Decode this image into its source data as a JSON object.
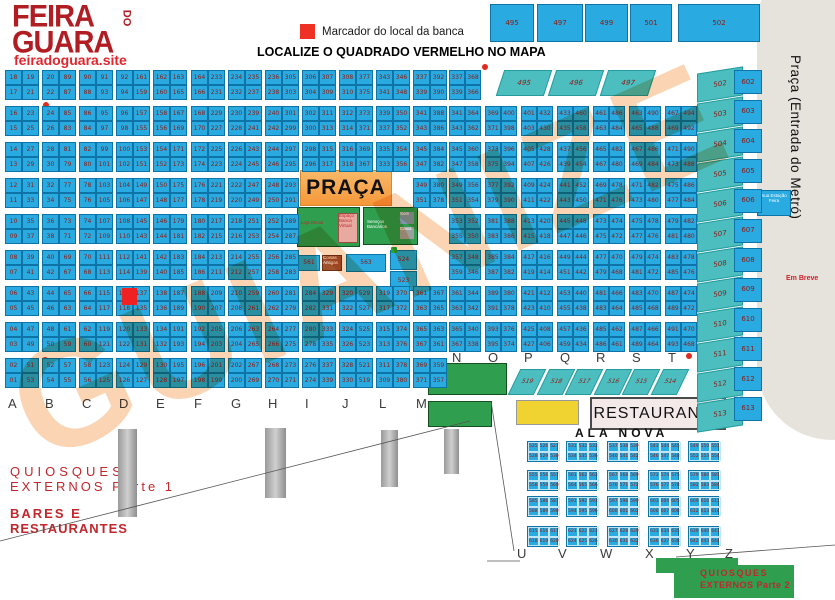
{
  "logo": {
    "line1": "FEIRA",
    "do_word": "DO",
    "line2": "GUARA",
    "site": "feiradoguara.site"
  },
  "legend": {
    "marker_label": "Marcador do local da banca"
  },
  "title": "LOCALIZE O QUADRADO VERMELHO NO MAPA",
  "watermark": "GUIANIZE",
  "colors": {
    "cell_blue": "#29ABE2",
    "teal": "#4CBEC0",
    "brand_red": "#C1272D",
    "marker_red": "#EE2222",
    "praca_orange": "#F5983A",
    "green": "#2F9E4E",
    "yellow": "#F0D231"
  },
  "top_cells": [
    "495",
    "497",
    "499",
    "501",
    "502"
  ],
  "metro": {
    "label": "Praça (Entrada do Metró)",
    "em_breve": "Em Breve",
    "station_box": "Sua Estação Feira"
  },
  "praca": {
    "label": "PRAÇA"
  },
  "green_blocks": {
    "gb1_main": "Loja Oficial",
    "gb1_sub": "Espaço Banca Virtual",
    "gb2_main": "Serviços Bancários",
    "gb2_sub1": "Som",
    "gb2_sub2": "Caixa"
  },
  "special_cells": {
    "c561": "561",
    "brown": "Coisas Antigas",
    "c563": "563",
    "c524": "524",
    "c523": "523"
  },
  "left_grid": {
    "letters": [
      "A",
      "B",
      "C",
      "D",
      "E",
      "F",
      "G",
      "H",
      "I",
      "J",
      "L",
      "M"
    ],
    "columns": [
      {
        "letter": "A",
        "rows": [
          "18|19",
          "17|21",
          "16|23",
          "15|25",
          "14|27",
          "13|29",
          "12|31",
          "11|33",
          "10|35",
          "09|37",
          "08|39",
          "07|41",
          "06|43",
          "05|45",
          "04|47",
          "03|49",
          "02|51",
          "01|53"
        ]
      },
      {
        "letter": "B",
        "rows": [
          "20|89",
          "22|87",
          "24|85",
          "26|83",
          "28|81",
          "30|79",
          "32|77",
          "34|75",
          "36|73",
          "38|71",
          "40|69",
          "42|67",
          "44|65",
          "46|63",
          "48|61",
          "50|59",
          "52|57",
          "54|55"
        ]
      },
      {
        "letter": "C",
        "rows": [
          "90|91",
          "88|93",
          "86|95",
          "84|97",
          "82|99",
          "80|101",
          "78|103",
          "76|105",
          "74|107",
          "72|109",
          "70|111",
          "68|113",
          "66|115",
          "64|117",
          "62|119",
          "60|121",
          "58|123",
          "56|125"
        ]
      },
      {
        "letter": "D",
        "rows": [
          "92|161",
          "94|159",
          "96|157",
          "98|155",
          "100|153",
          "102|151",
          "104|149",
          "106|147",
          "108|145",
          "110|143",
          "112|141",
          "114|139",
          "116|137",
          "118|135",
          "120|133",
          "122|131",
          "124|129",
          "126|127"
        ]
      },
      {
        "letter": "E",
        "rows": [
          "162|163",
          "160|165",
          "158|167",
          "156|169",
          "154|171",
          "152|173",
          "150|175",
          "148|177",
          "146|179",
          "144|181",
          "142|183",
          "140|185",
          "138|187",
          "136|189",
          "134|191",
          "132|193",
          "130|195",
          "128|197"
        ]
      },
      {
        "letter": "F",
        "rows": [
          "164|233",
          "166|231",
          "168|229",
          "170|227",
          "172|225",
          "174|223",
          "176|221",
          "178|219",
          "180|217",
          "182|215",
          "184|213",
          "186|211",
          "188|209",
          "190|207",
          "192|205",
          "194|203",
          "196|201",
          "198|199"
        ]
      },
      {
        "letter": "G",
        "rows": [
          "234|235",
          "232|237",
          "230|239",
          "228|241",
          "226|243",
          "224|245",
          "222|247",
          "220|249",
          "218|251",
          "216|253",
          "214|255",
          "212|257",
          "210|259",
          "208|261",
          "206|263",
          "204|265",
          "202|267",
          "200|269"
        ]
      },
      {
        "letter": "H",
        "rows": [
          "236|305",
          "238|303",
          "240|301",
          "242|299",
          "244|297",
          "246|295",
          "248|293",
          "250|291",
          "252|289",
          "254|287",
          "256|285",
          "258|283",
          "260|281",
          "262|279",
          "264|277",
          "266|275",
          "268|273",
          "270|271"
        ]
      },
      {
        "letter": "I",
        "rows": [
          "306|307",
          "304|309",
          "302|311",
          "300|313",
          "298|315",
          "296|317",
          null,
          null,
          null,
          null,
          null,
          null,
          "284|329",
          "282|331",
          "280|333",
          "278|335",
          "276|337",
          "274|339"
        ]
      },
      {
        "letter": "J",
        "rows": [
          "308|377",
          "310|375",
          "312|373",
          "314|371",
          "316|369",
          "318|367",
          null,
          null,
          null,
          null,
          null,
          null,
          "320|529",
          "322|527",
          "324|525",
          "326|523",
          "328|521",
          "330|519"
        ]
      },
      {
        "letter": "L",
        "rows": [
          "343|346",
          "341|348",
          "339|350",
          "337|352",
          "335|354",
          "333|356",
          null,
          null,
          null,
          null,
          null,
          null,
          "319|370",
          "317|372",
          "315|374",
          "313|376",
          "311|378",
          "309|380"
        ]
      },
      {
        "letter": "M",
        "rows": [
          "337|392",
          "339|390",
          "341|388",
          "343|386",
          "345|384",
          "347|382",
          "349|380",
          "351|378",
          null,
          null,
          null,
          null,
          "361|367",
          "363|365",
          "365|363",
          "367|361",
          "369|359",
          "371|357"
        ]
      }
    ]
  },
  "right_grid": {
    "letters": [
      "N",
      "O",
      "P",
      "Q",
      "R",
      "S",
      "T"
    ],
    "columns": [
      {
        "letter": "N",
        "rows": [
          "337|368",
          "339|366",
          "341|364",
          "343|362",
          "345|360",
          "347|358",
          "349|356",
          "351|354",
          "353|352",
          "355|350",
          "357|348",
          "359|346",
          "361|344",
          "363|342",
          "365|340",
          "367|338"
        ]
      },
      {
        "letter": "O",
        "rows": [
          null,
          null,
          "369|400",
          "371|398",
          "373|396",
          "375|394",
          "377|392",
          "379|390",
          "381|388",
          "383|386",
          "385|384",
          "387|382",
          "389|380",
          "391|378",
          "393|376",
          "395|374"
        ]
      },
      {
        "letter": "P",
        "rows": [
          null,
          null,
          "401|432",
          "403|430",
          "405|428",
          "407|426",
          "409|424",
          "411|422",
          "413|420",
          "415|418",
          "417|416",
          "419|414",
          "421|412",
          "423|410",
          "425|408",
          "427|406"
        ]
      },
      {
        "letter": "Q",
        "rows": [
          null,
          null,
          "433|460",
          "435|458",
          "437|456",
          "439|454",
          "441|452",
          "443|450",
          "445|448",
          "447|446",
          "449|444",
          "451|442",
          "453|440",
          "455|438",
          "457|436",
          "459|434"
        ]
      },
      {
        "letter": "R",
        "rows": [
          null,
          null,
          "461|486",
          "463|484",
          "465|482",
          "467|480",
          "469|478",
          "471|476",
          "473|474",
          "475|472",
          "477|470",
          "479|468",
          "481|466",
          "483|464",
          "485|462",
          "486|461"
        ]
      },
      {
        "letter": "S",
        "rows": [
          null,
          null,
          "463|490",
          "465|488",
          "467|486",
          "469|484",
          "471|482",
          "473|480",
          "475|478",
          "477|476",
          "479|474",
          "481|472",
          "483|470",
          "485|468",
          "487|466",
          "489|464"
        ]
      },
      {
        "letter": "T",
        "rows": [
          null,
          null,
          "467|494",
          "469|492",
          "471|490",
          "473|488",
          "475|486",
          "477|484",
          "479|482",
          "481|480",
          "483|478",
          "485|476",
          "487|474",
          "489|472",
          "491|470",
          "493|468"
        ]
      }
    ]
  },
  "slanted_top": [
    "495",
    "496",
    "497"
  ],
  "diagonal_row": [
    "519",
    "518",
    "517",
    "516",
    "515",
    "514"
  ],
  "teal_column": [
    "502",
    "503",
    "504",
    "505",
    "506",
    "507",
    "508",
    "509",
    "510",
    "511",
    "512",
    "513"
  ],
  "blue_column": [
    "602",
    "603",
    "604",
    "605",
    "606",
    "607",
    "608",
    "609",
    "610",
    "611",
    "612",
    "613"
  ],
  "restaurante": "RESTAURANTE",
  "ala_nova": {
    "label": "ALA NOVA",
    "letters": [
      "U",
      "V",
      "W",
      "X",
      "Y",
      "Z"
    ],
    "block_rows": [
      [
        [
          "525 526 527",
          "528 529 530"
        ],
        [
          "531 532 533",
          "534 535 536"
        ],
        [
          "537 538 539",
          "540 541 542"
        ],
        [
          "543 544 545",
          "546 547 548"
        ],
        [
          "549 550 551",
          "552 553 554"
        ]
      ],
      [
        [
          "555 556 557",
          "558 559 560"
        ],
        [
          "561 562 563",
          "564 565 566"
        ],
        [
          "567 568 569",
          "570 571 572"
        ],
        [
          "573 574 575",
          "576 577 578"
        ],
        [
          "579 580 581",
          "582 583 584"
        ]
      ],
      [
        [
          "585 586 587",
          "588 589 590"
        ],
        [
          "591 592 593",
          "594 595 596"
        ],
        [
          "597 598 599",
          "600 601 602"
        ],
        [
          "603 604 605",
          "606 607 608"
        ],
        [
          "609 610 611",
          "612 613 614"
        ]
      ],
      [
        [
          "615 616 617",
          "618 619 620"
        ],
        [
          "621 622 623",
          "624 625 626"
        ],
        [
          "627 628 629",
          "630 631 632"
        ],
        [
          "633 634 635",
          "636 637 638"
        ],
        [
          "639 640 641",
          "642 643 644"
        ]
      ]
    ]
  },
  "bottom_left": {
    "q1_line1": "QUIOSQUES",
    "q1_line2": "EXTERNOS Parte 1",
    "bares_line1": "BARES E",
    "bares_line2": "RESTAURANTES"
  },
  "bottom_right": {
    "q2_line1": "QUIOSQUES",
    "q2_line2": "EXTERNOS Parte 2"
  }
}
